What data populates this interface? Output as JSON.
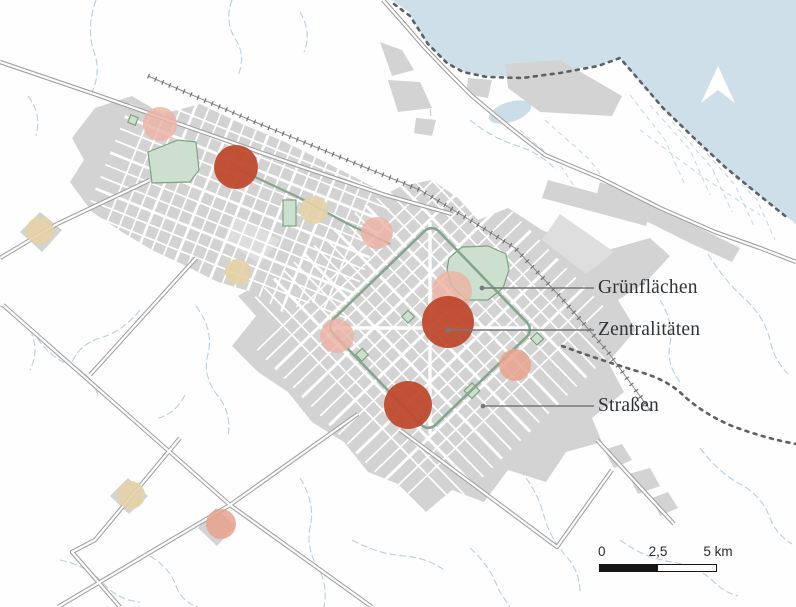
{
  "map": {
    "annotations": {
      "items": [
        {
          "label": "Grünflächen",
          "target": "green-space"
        },
        {
          "label": "Zentralitäten",
          "target": "centrality-circle"
        },
        {
          "label": "Straßen",
          "target": "street"
        }
      ]
    },
    "scale_bar": {
      "tick_start": "0",
      "tick_mid": "2,5",
      "tick_end": "5 km"
    },
    "icons": {
      "north_arrow": "north-arrow-icon"
    },
    "colors": {
      "water": "#cfdfe9",
      "urban": "#d3d3d3",
      "urban_light": "#dedede",
      "green_space_fill": "#cde0d0",
      "green_space_stroke": "#7fa184",
      "green_boulevard": "#87a58c",
      "centrality_major": "#bf4a2e",
      "centrality_medium": "#edb2a3",
      "centrality_medium_alt": "#e8a28c",
      "centrality_minor": "#e4d2a6",
      "boundary": "#5c6166",
      "stream": "#b9cfdf",
      "road_casing": "#a2a2a2",
      "leader": "#74797c",
      "label_text": "#2e3338"
    }
  }
}
